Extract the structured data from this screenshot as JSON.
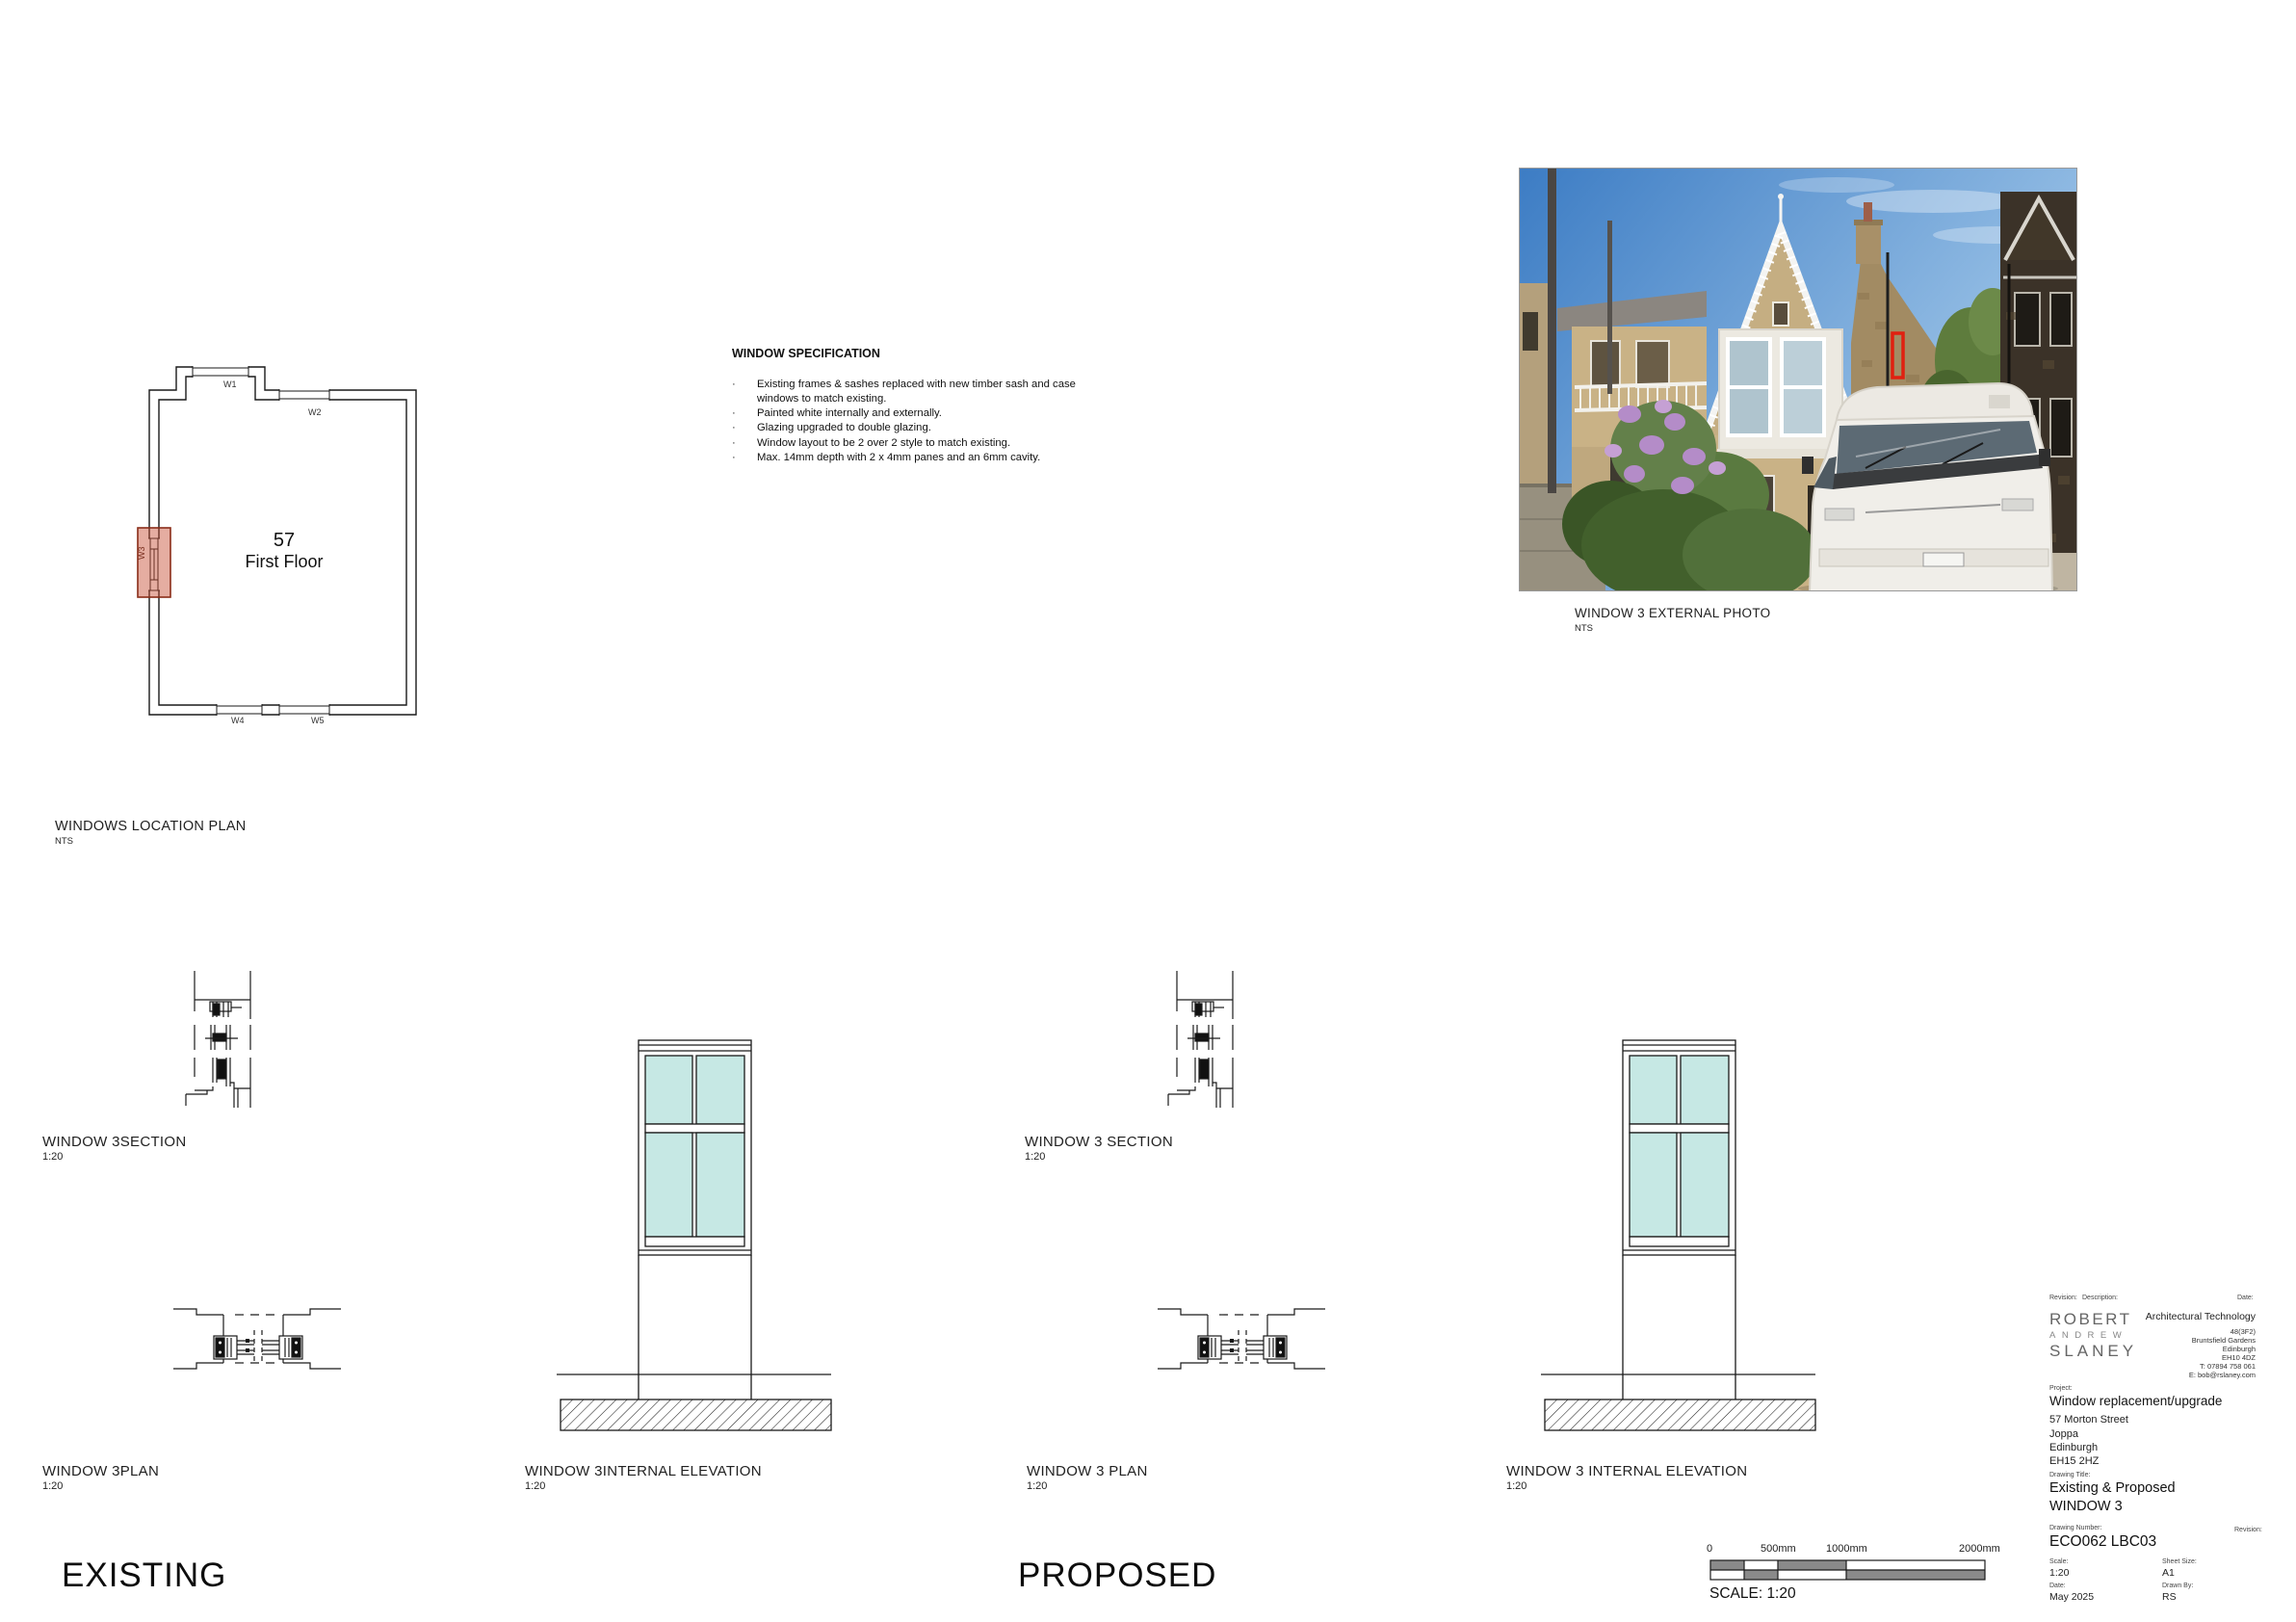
{
  "colors": {
    "glazing": "#c6e8e4",
    "highlight_fill": "rgba(197,74,47,0.45)",
    "highlight_border": "#8a2d18",
    "photo_marker_red": "#e02010",
    "scale_bar_gray": "#8a8a8a"
  },
  "location_plan": {
    "title": "WINDOWS LOCATION PLAN",
    "scale": "NTS",
    "room_number": "57",
    "room_name": "First Floor",
    "w1": "W1",
    "w2": "W2",
    "w3": "W3",
    "w4": "W4",
    "w5": "W5"
  },
  "specification": {
    "title": "WINDOW SPECIFICATION",
    "bullet": "·",
    "items": [
      "Existing frames & sashes replaced with new timber sash and case windows to match existing.",
      "Painted white internally and externally.",
      "Glazing upgraded to double glazing.",
      "Window layout to be 2 over 2 style to match existing.",
      "Max. 14mm depth with 2 x 4mm panes and an 6mm cavity."
    ]
  },
  "photo": {
    "caption": "WINDOW 3 EXTERNAL PHOTO",
    "scale": "NTS"
  },
  "existing": {
    "heading": "EXISTING",
    "section_title": "WINDOW 3SECTION",
    "section_scale": "1:20",
    "plan_title": "WINDOW 3PLAN",
    "plan_scale": "1:20",
    "elevation_title": "WINDOW 3INTERNAL ELEVATION",
    "elevation_scale": "1:20"
  },
  "proposed": {
    "heading": "PROPOSED",
    "section_title": "WINDOW 3 SECTION",
    "section_scale": "1:20",
    "plan_title": "WINDOW 3 PLAN",
    "plan_scale": "1:20",
    "elevation_title": "WINDOW 3 INTERNAL ELEVATION",
    "elevation_scale": "1:20"
  },
  "scale_bar": {
    "t0": "0",
    "t500": "500mm",
    "t1000": "1000mm",
    "t2000": "2000mm",
    "caption": "SCALE: 1:20"
  },
  "title_block": {
    "rev_label": "Revision:",
    "desc_label": "Description:",
    "date_header_label": "Date:",
    "firm_line1": "ROBERT",
    "firm_line2": "ANDREW",
    "firm_line3": "SLANEY",
    "discipline": "Architectural Technology",
    "addr1": "48(3F2)",
    "addr2": "Bruntsfield Gardens",
    "addr3": "Edinburgh",
    "addr4": "EH10 4DZ",
    "addr5": "T: 07894 758 061",
    "addr6": "E: bob@rslaney.com",
    "project_label": "Project:",
    "project_name": "Window replacement/upgrade",
    "proj_addr1": "57 Morton Street",
    "proj_addr2": "Joppa",
    "proj_addr3": "Edinburgh",
    "proj_addr4": "EH15 2HZ",
    "drawing_title_label": "Drawing Title:",
    "drawing_title1": "Existing & Proposed",
    "drawing_title2": "WINDOW 3",
    "drawing_number_label": "Drawing Number:",
    "drawing_number": "ECO062 LBC03",
    "revision_label2": "Revision:",
    "scale_label": "Scale:",
    "scale_value": "1:20",
    "sheet_size_label": "Sheet Size:",
    "sheet_size_value": "A1",
    "date_label": "Date:",
    "date_value": "May 2025",
    "drawn_by_label": "Drawn By:",
    "drawn_by_value": "RS"
  }
}
